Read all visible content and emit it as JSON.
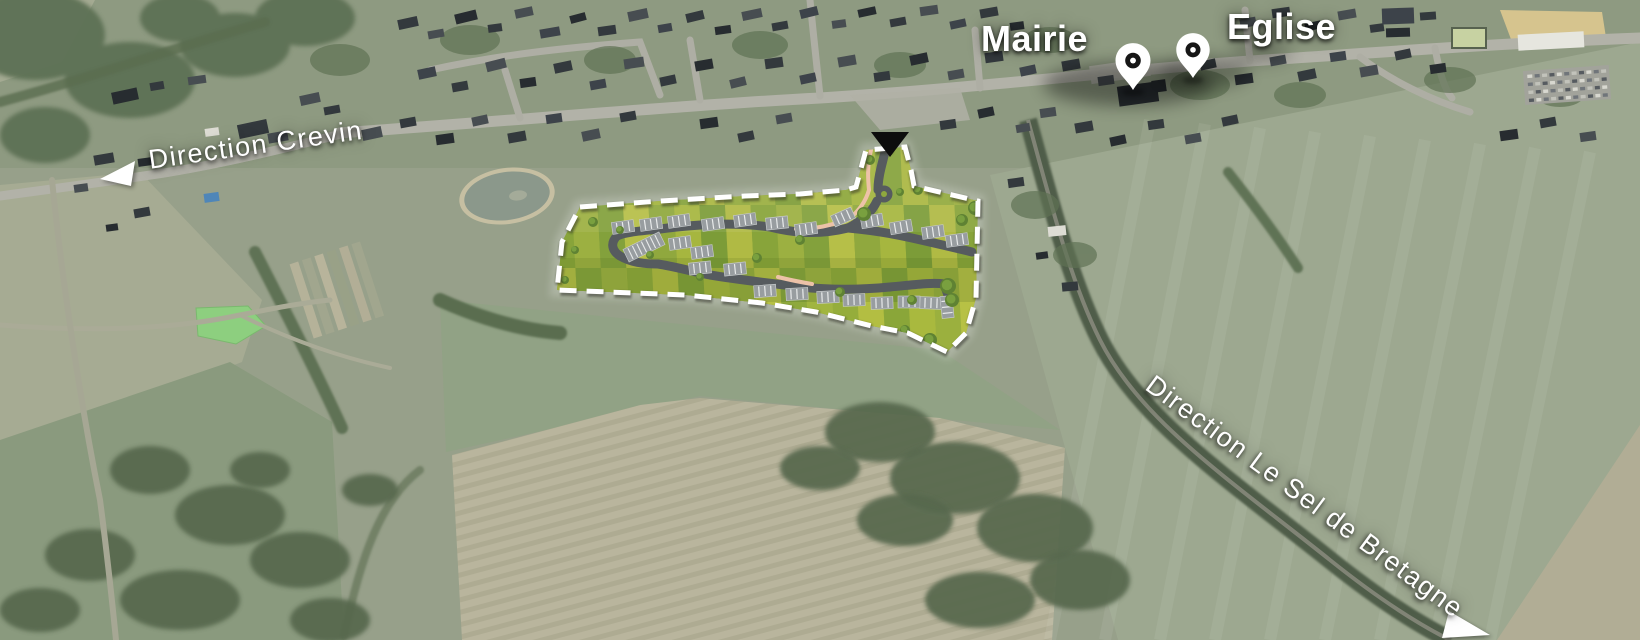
{
  "map": {
    "landmarks": [
      {
        "label": "Mairie",
        "icon": "map-pin"
      },
      {
        "label": "Eglise",
        "icon": "map-pin"
      }
    ],
    "directions": [
      {
        "label": "Direction Crevin",
        "arrow": "left"
      },
      {
        "label": "Direction Le Sel de Bretagne",
        "arrow": "down-right"
      }
    ],
    "site": {
      "entrance_marker_icon": "black-triangle",
      "boundary_style": "white-dashed"
    },
    "colors": {
      "label_text": "#ffffff",
      "pin_fill": "#ffffff",
      "pin_ring": "#161616",
      "site_boundary": "#ffffff",
      "site_road": "#565b5f",
      "footpath": "#edc2a8",
      "entrance_marker": "#0d0d0d",
      "site_lot_greens": [
        "#a6b63f",
        "#88a43a",
        "#b6bf48",
        "#7c9c38",
        "#9cb041",
        "#90a83e",
        "#b0ba44",
        "#83a13c"
      ]
    }
  }
}
